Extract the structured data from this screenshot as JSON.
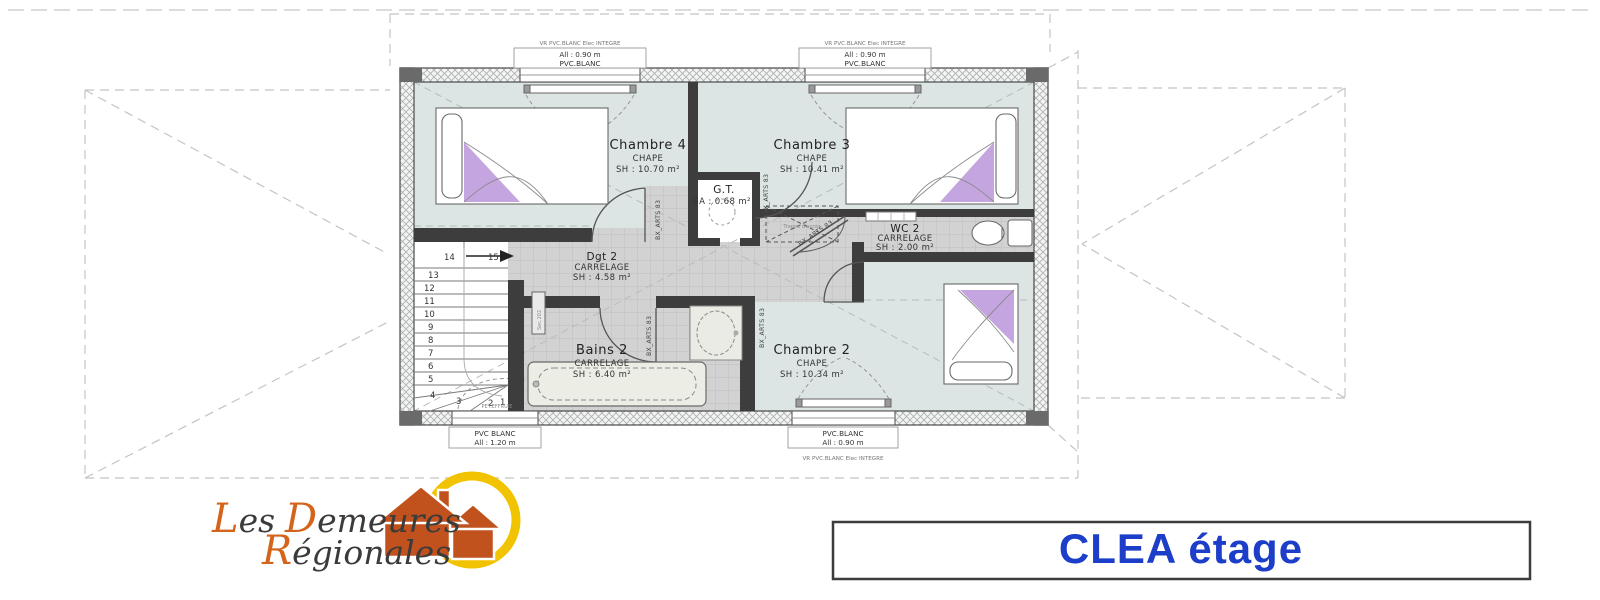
{
  "plan": {
    "rooms": {
      "chambre4": {
        "name": "Chambre 4",
        "finish": "CHAPE",
        "area": "SH : 10.70 m²"
      },
      "chambre3": {
        "name": "Chambre 3",
        "finish": "CHAPE",
        "area": "SH : 10.41 m²"
      },
      "gt": {
        "name": "G.T.",
        "area": "SA : 0.68 m²"
      },
      "wc2": {
        "name": "WC 2",
        "finish": "CARRELAGE",
        "area": "SH : 2.00 m²"
      },
      "dgt2": {
        "name": "Dgt 2",
        "finish": "CARRELAGE",
        "area": "SH : 4.58 m²"
      },
      "bains2": {
        "name": "Bains 2",
        "finish": "CARRELAGE",
        "area": "SH : 6.40 m²"
      },
      "chambre2": {
        "name": "Chambre 2",
        "finish": "CHAPE",
        "area": "SH : 10.34 m²"
      }
    },
    "windows": {
      "vr_note": "VR PVC.BLANC Elec INTEGRE",
      "top_left": {
        "l1": "All : 0.90 m",
        "l2": "PVC.BLANC"
      },
      "top_right": {
        "l1": "All : 0.90 m",
        "l2": "PVC.BLANC"
      },
      "bottom_bath": {
        "l1": "PVC BLANC",
        "l2": "All : 1.20 m"
      },
      "bottom_ch2": {
        "l1": "PVC.BLANC",
        "l2": "All : 0.90 m"
      },
      "bath_note": "PET.EFFRUIE"
    },
    "door_label": "BX_ARTS 83",
    "stair_numbers": [
      "1",
      "2",
      "3",
      "4",
      "5",
      "6",
      "7",
      "8",
      "9",
      "10",
      "11",
      "12",
      "13",
      "14",
      "15"
    ],
    "trap_label": "Trappe d'accès",
    "radiator_label": "Sec.202"
  },
  "logo": {
    "w1a": "L",
    "w1b": "es",
    "w2a": "D",
    "w2b": "emeures",
    "w3a": "R",
    "w3b": "égionales"
  },
  "title": {
    "text": "CLEA étage"
  },
  "colors": {
    "accent_blue": "#1c3ec9",
    "logo_orange": "#c9591f",
    "logo_yellow": "#f2c300",
    "bedroom_fill": "#dce4e4",
    "tile_fill": "#d2d2d2"
  }
}
